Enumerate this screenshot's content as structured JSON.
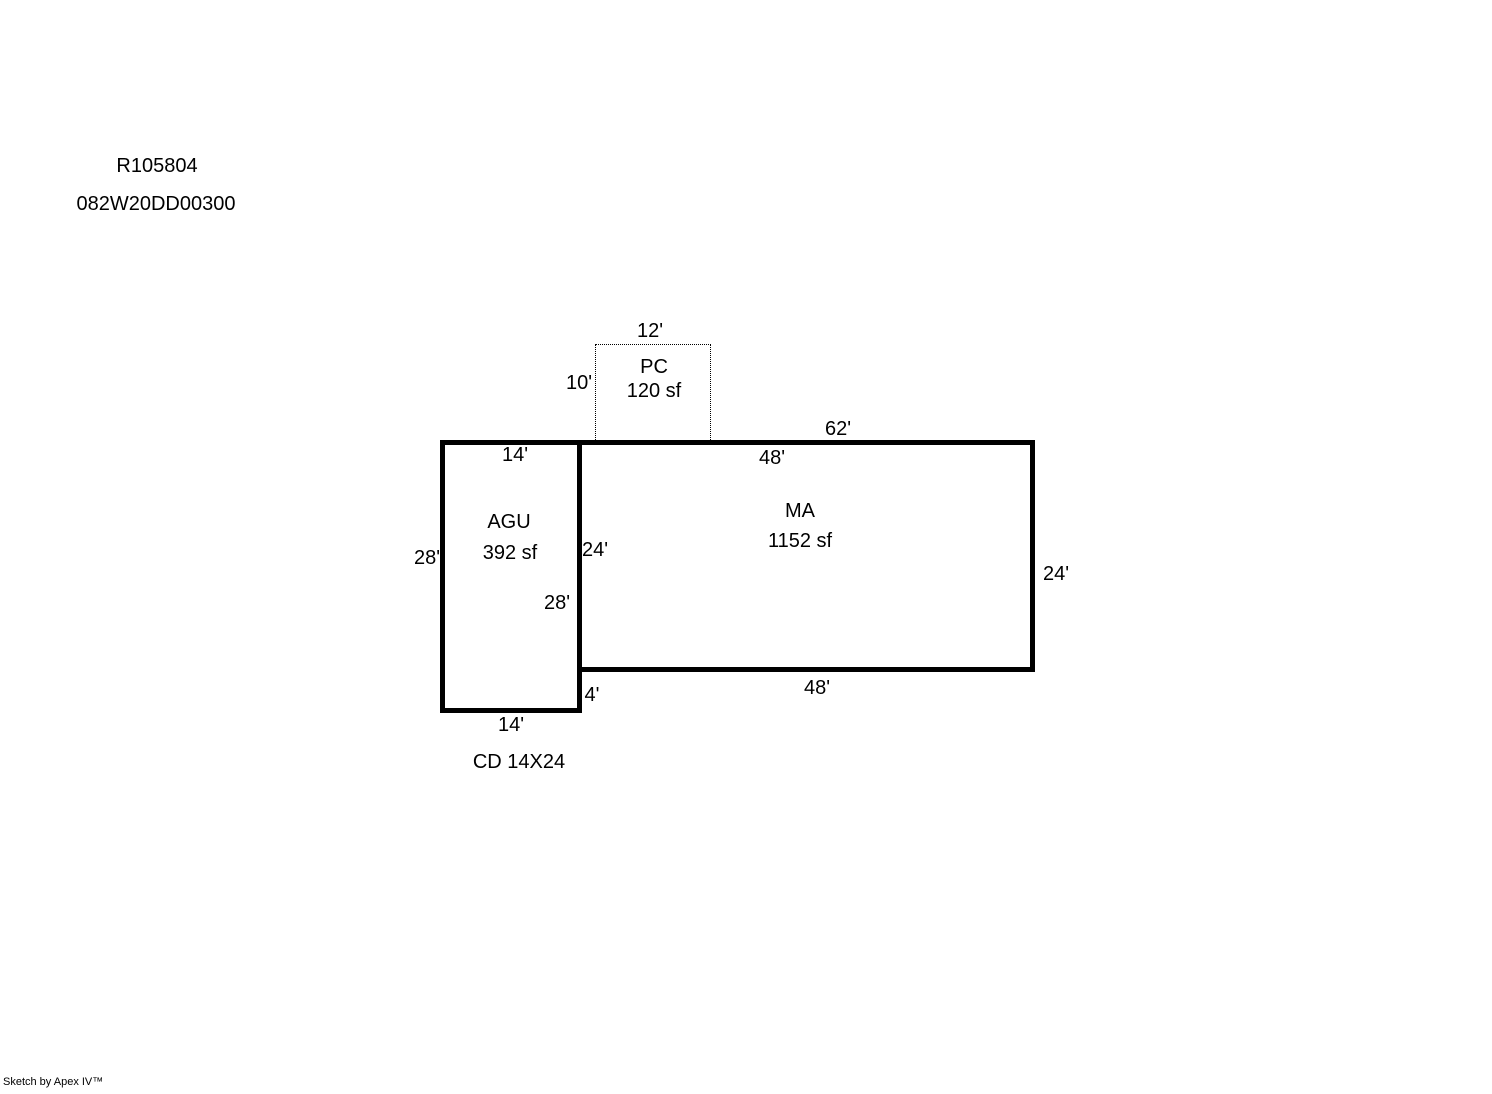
{
  "header": {
    "record_id": "R105804",
    "parcel_id": "082W20DD00300"
  },
  "footer": {
    "credit": "Sketch by Apex IV™"
  },
  "sketch": {
    "areas": {
      "pc": {
        "code": "PC",
        "area": "120 sf"
      },
      "ma": {
        "code": "MA",
        "area": "1152 sf"
      },
      "agu": {
        "code": "AGU",
        "area": "392 sf"
      }
    },
    "dims": {
      "pc_top": "12'",
      "pc_left": "10'",
      "top_total": "62'",
      "ma_top": "48'",
      "ma_right": "24'",
      "ma_bottom": "48'",
      "ma_left": "24'",
      "agu_top": "14'",
      "agu_left": "28'",
      "agu_right": "28'",
      "agu_bottom": "14'",
      "offset": "4'"
    },
    "note": "CD 14X24"
  }
}
